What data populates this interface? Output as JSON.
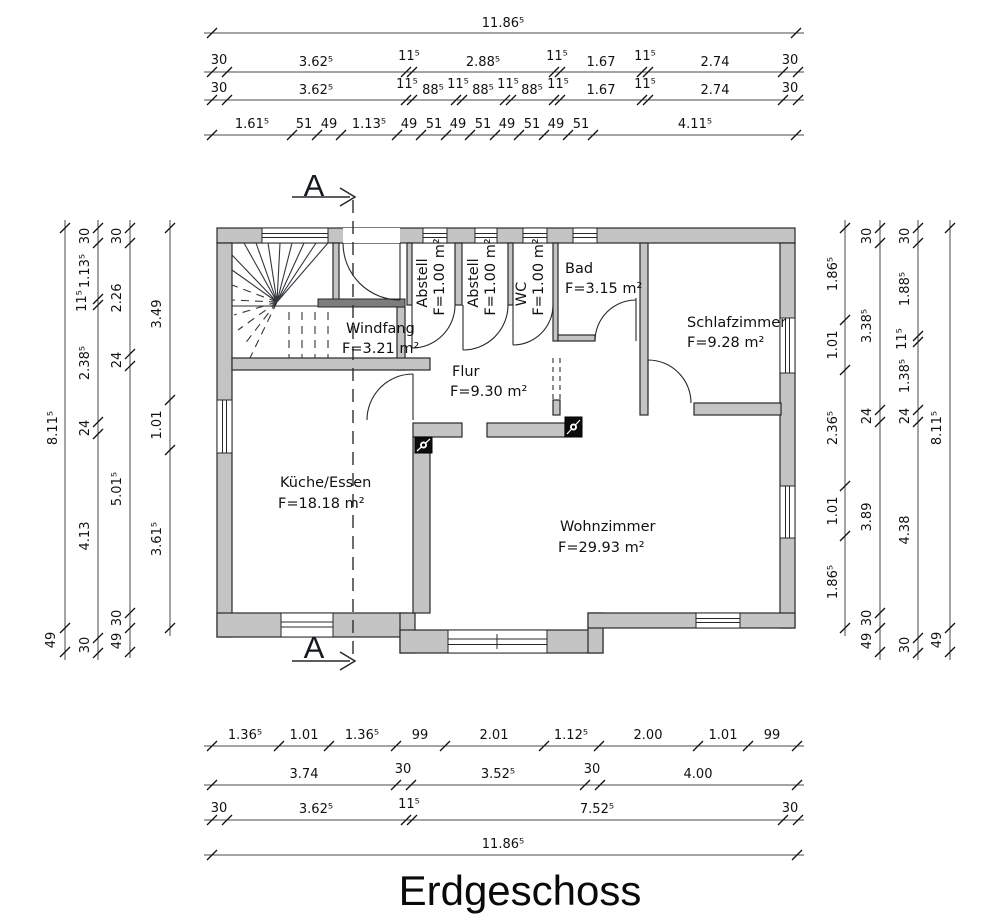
{
  "title": "Erdgeschoss",
  "section": {
    "label": "A"
  },
  "rooms": {
    "windfang": {
      "name": "Windfang",
      "area": "F=3.21 m²"
    },
    "abstell1": {
      "name": "Abstell",
      "area": "F=1.00  m²"
    },
    "abstell2": {
      "name": "Abstell",
      "area": "F=1.00  m²"
    },
    "wc": {
      "name": "WC",
      "area": "F=1.00  m²"
    },
    "bad": {
      "name": "Bad",
      "area": "F=3.15  m²"
    },
    "schlafzimmer": {
      "name": "Schlafzimmer",
      "area": "F=9.28  m²"
    },
    "flur": {
      "name": "Flur",
      "area": "F=9.30  m²"
    },
    "kueche": {
      "name": "Küche/Essen",
      "area": "F=18.18  m²"
    },
    "wohnzimmer": {
      "name": "Wohnzimmer",
      "area": "F=29.93  m²"
    }
  },
  "dims": {
    "top": {
      "total": "11.86⁵",
      "row1": [
        "30",
        "3.62⁵",
        "11⁵",
        "2.88⁵",
        "11⁵",
        "1.67",
        "11⁵",
        "2.74",
        "30"
      ],
      "row2": [
        "30",
        "3.62⁵",
        "11⁵",
        "88⁵",
        "11⁵",
        "88⁵",
        "11⁵",
        "88⁵",
        "11⁵",
        "1.67",
        "11⁵",
        "2.74",
        "30"
      ],
      "row3": [
        "1.61⁵",
        "51",
        "49",
        "1.13⁵",
        "49",
        "51",
        "49",
        "51",
        "49",
        "51",
        "49",
        "51",
        "4.11⁵"
      ]
    },
    "bottom": {
      "row1": [
        "1.36⁵",
        "1.01",
        "1.36⁵",
        "99",
        "2.01",
        "1.12⁵",
        "2.00",
        "1.01",
        "99"
      ],
      "row2": [
        "3.74",
        "30",
        "3.52⁵",
        "30",
        "4.00"
      ],
      "row3": [
        "30",
        "3.62⁵",
        "11⁵",
        "7.52⁵",
        "30"
      ],
      "total": "11.86⁵"
    },
    "left": {
      "chainA": [
        "8.11⁵",
        "49"
      ],
      "chainB": [
        "30",
        "1.13⁵",
        "11⁵",
        "2.38⁵",
        "24",
        "4.13",
        "30"
      ],
      "chainC": [
        "30",
        "2.26",
        "24",
        "5.01⁵",
        "30",
        "49"
      ],
      "chainD": [
        "3.49",
        "1.01",
        "3.61⁵"
      ]
    },
    "right": {
      "chainE": [
        "1.86⁵",
        "1.01",
        "2.36⁵",
        "1.01",
        "1.86⁵"
      ],
      "chainF": [
        "30",
        "3.38⁵",
        "24",
        "3.89",
        "30",
        "49"
      ],
      "chainG": [
        "30",
        "1.88⁵",
        "11⁵",
        "1.38⁵",
        "24",
        "4.38",
        "30"
      ],
      "chainH": [
        "8.11⁵",
        "49"
      ]
    }
  }
}
